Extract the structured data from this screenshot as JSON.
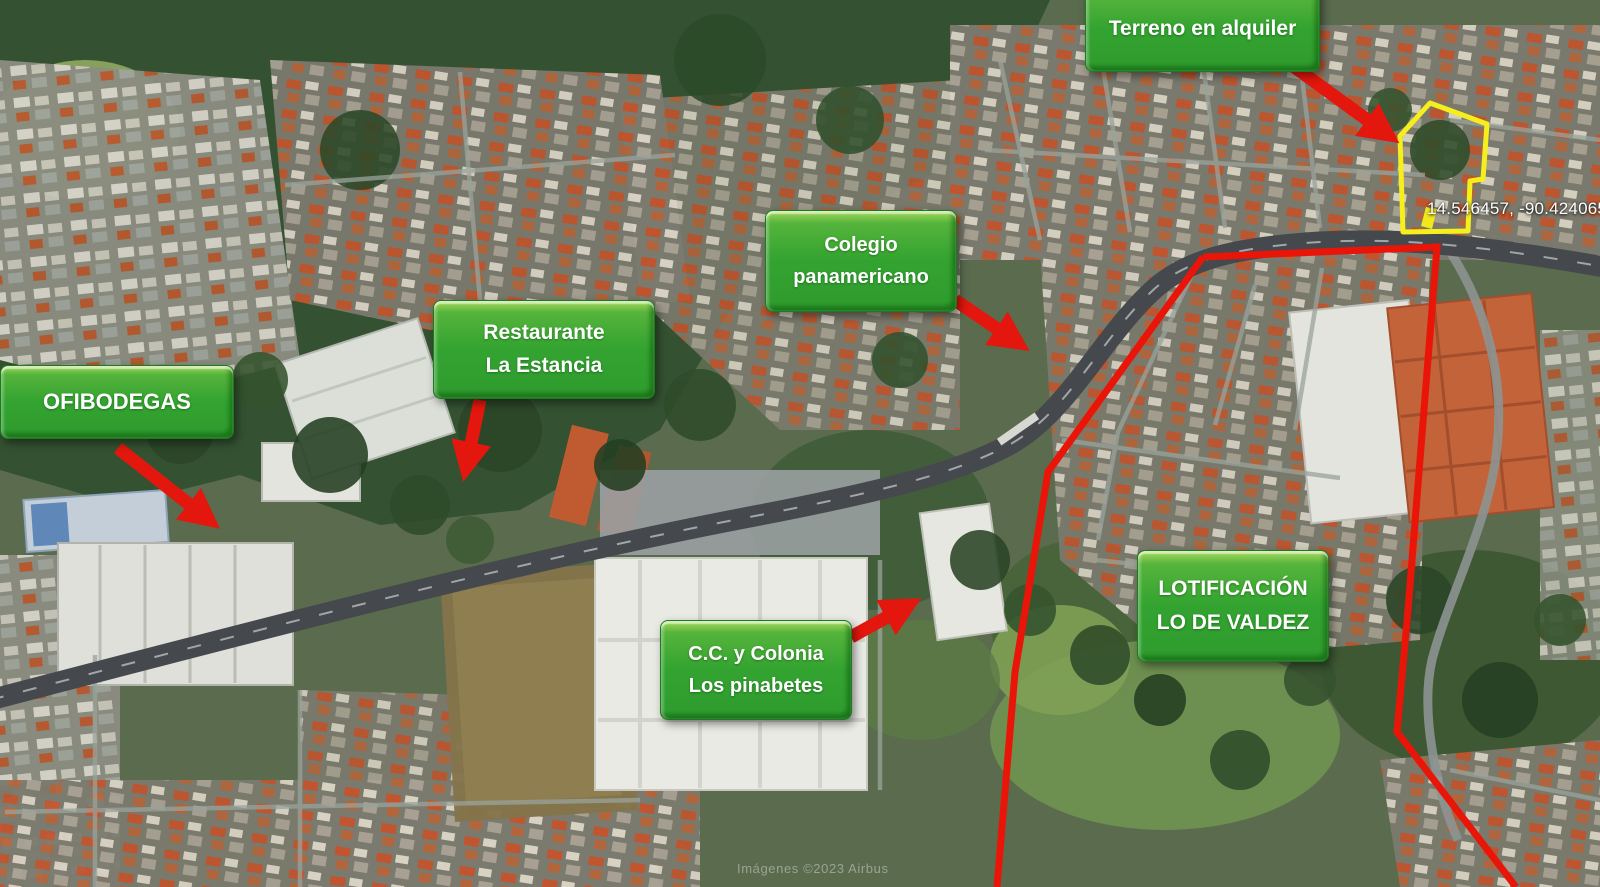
{
  "map": {
    "labels": {
      "terreno": {
        "text": "Terreno en alquiler"
      },
      "colegio": {
        "line1": "Colegio",
        "line2": "panamericano"
      },
      "restaurante": {
        "line1": "Restaurante",
        "line2": "La Estancia"
      },
      "ofibodegas": {
        "text": "OFIBODEGAS"
      },
      "cc_pinabetes": {
        "line1": "C.C. y Colonia",
        "line2": "Los pinabetes"
      },
      "lotificacion": {
        "line1": "LOTIFICACIÓN",
        "line2": "LO DE VALDEZ"
      }
    },
    "overlay": {
      "coordinates": "14.546457, -90.424065",
      "watermark": "Imágenes ©2023 Airbus"
    },
    "colors": {
      "label_green": "#2f9c2e",
      "annotation_red": "#e3170d",
      "property_outline_yellow": "#f6ef1b"
    }
  }
}
